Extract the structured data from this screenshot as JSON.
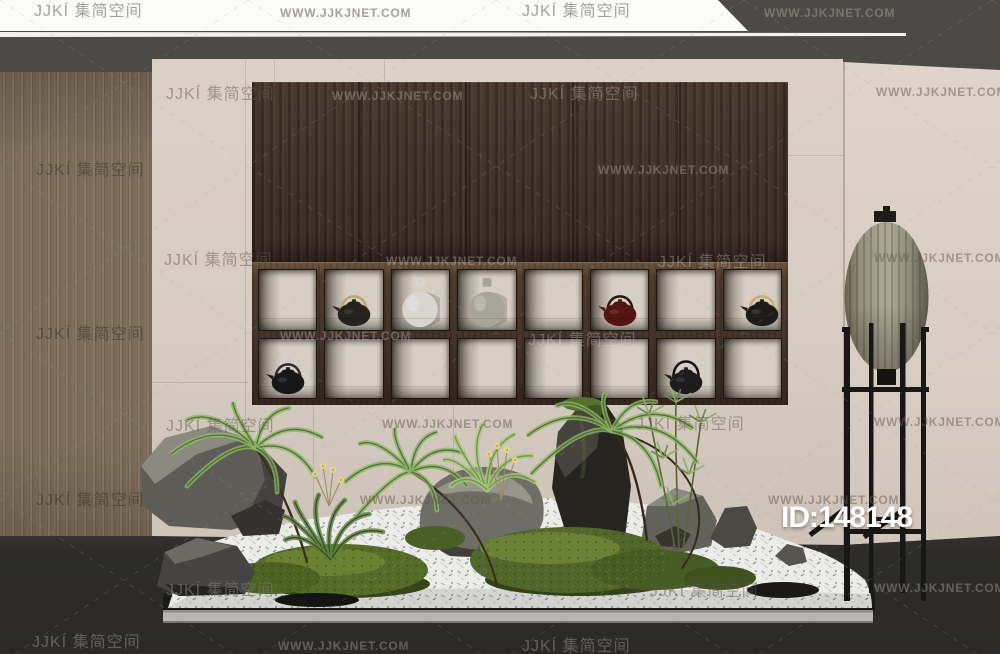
{
  "site": {
    "brand": "JJKÍ 集简空间",
    "url": "WWW.JJKJNET.COM"
  },
  "id_label": "ID:148148",
  "palette": {
    "dark_top": "#4b4a46",
    "wall_center": "#d6ccc2",
    "wall_right": "#d8cec3",
    "wood_panel": "#7a6b5a",
    "cabinet_wood": "#43332a",
    "shelf_frame": "#4e3c2c",
    "floor": "#2d2c29",
    "banner": "#fbfbf9",
    "lantern_shade": "#a5a192",
    "lamp_stand": "#171715",
    "gravel": "#ececea",
    "moss": "#50662a",
    "rock": "#5d5c56",
    "id_color": "#ffffff"
  },
  "shelf": {
    "rows": 2,
    "cols": 8,
    "items": [
      {
        "row": 1,
        "col": 2,
        "type": "teapot",
        "name": "black-teapot-gold-handle",
        "body": "#24211e",
        "handle": "#c2a368"
      },
      {
        "row": 1,
        "col": 3,
        "type": "vase",
        "name": "white-round-vase",
        "body": "#d9d6cf"
      },
      {
        "row": 1,
        "col": 4,
        "type": "vase",
        "name": "gray-round-vase",
        "body": "#a7a698"
      },
      {
        "row": 1,
        "col": 6,
        "type": "teapot",
        "name": "dark-red-teapot",
        "body": "#551414",
        "handle": "#261712"
      },
      {
        "row": 1,
        "col": 8,
        "type": "teapot",
        "name": "black-teapot-gold-handle-right",
        "body": "#1e1c1a",
        "handle": "#c9ad74",
        "shift": 10
      },
      {
        "row": 2,
        "col": 1,
        "type": "teapot",
        "name": "dark-teapot",
        "body": "#17171a",
        "handle": "#2c2c30"
      },
      {
        "row": 2,
        "col": 7,
        "type": "teapot",
        "name": "black-teapot-tall-handle",
        "body": "#1c1c1f",
        "handle": "#121215"
      }
    ]
  },
  "watermarks": [
    {
      "kind": "brand",
      "x": 34,
      "y": 3,
      "tone": "banner"
    },
    {
      "kind": "url",
      "x": 280,
      "y": 7,
      "tone": "banner"
    },
    {
      "kind": "brand",
      "x": 522,
      "y": 3,
      "tone": "banner"
    },
    {
      "kind": "url",
      "x": 764,
      "y": 7,
      "tone": "light"
    },
    {
      "kind": "brand",
      "x": 166,
      "y": 86,
      "tone": "dark"
    },
    {
      "kind": "url",
      "x": 332,
      "y": 90,
      "tone": "light"
    },
    {
      "kind": "brand",
      "x": 530,
      "y": 86,
      "tone": "light"
    },
    {
      "kind": "url",
      "x": 876,
      "y": 86,
      "tone": "dark"
    },
    {
      "kind": "brand",
      "x": 36,
      "y": 162,
      "tone": "wood"
    },
    {
      "kind": "url",
      "x": 598,
      "y": 164,
      "tone": "light"
    },
    {
      "kind": "brand",
      "x": 164,
      "y": 252,
      "tone": "dark"
    },
    {
      "kind": "url",
      "x": 874,
      "y": 252,
      "tone": "dark"
    },
    {
      "kind": "url",
      "x": 386,
      "y": 255,
      "tone": "light"
    },
    {
      "kind": "brand",
      "x": 658,
      "y": 254,
      "tone": "light"
    },
    {
      "kind": "brand",
      "x": 36,
      "y": 326,
      "tone": "wood"
    },
    {
      "kind": "url",
      "x": 280,
      "y": 330,
      "tone": "light"
    },
    {
      "kind": "brand",
      "x": 528,
      "y": 332,
      "tone": "light"
    },
    {
      "kind": "brand",
      "x": 166,
      "y": 418,
      "tone": "dark"
    },
    {
      "kind": "url",
      "x": 382,
      "y": 418,
      "tone": "dark"
    },
    {
      "kind": "brand",
      "x": 636,
      "y": 416,
      "tone": "dark"
    },
    {
      "kind": "url",
      "x": 874,
      "y": 416,
      "tone": "dark"
    },
    {
      "kind": "brand",
      "x": 36,
      "y": 492,
      "tone": "wood"
    },
    {
      "kind": "url",
      "x": 360,
      "y": 494,
      "tone": "dark"
    },
    {
      "kind": "url",
      "x": 768,
      "y": 494,
      "tone": "dark"
    },
    {
      "kind": "brand",
      "x": 166,
      "y": 582,
      "tone": "mid"
    },
    {
      "kind": "brand",
      "x": 650,
      "y": 583,
      "tone": "dark"
    },
    {
      "kind": "url",
      "x": 874,
      "y": 582,
      "tone": "light"
    },
    {
      "kind": "brand",
      "x": 32,
      "y": 634,
      "tone": "light"
    },
    {
      "kind": "url",
      "x": 278,
      "y": 640,
      "tone": "light"
    },
    {
      "kind": "brand",
      "x": 522,
      "y": 638,
      "tone": "light"
    }
  ]
}
